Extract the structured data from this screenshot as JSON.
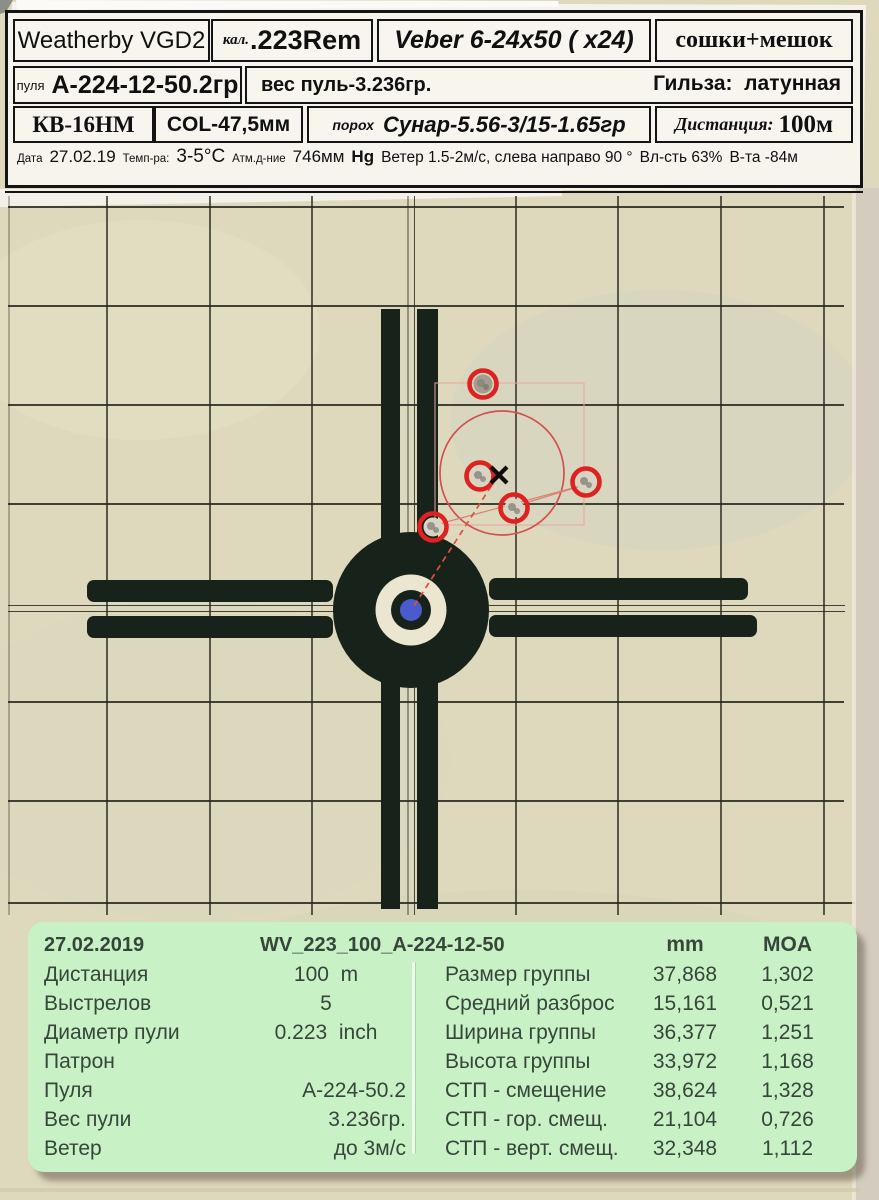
{
  "colors": {
    "paper": "#ded9bc",
    "cross_black": "#17221a",
    "grid_line": "#26261e",
    "bull_blue": "#4a5bcb",
    "annotation_red": "#d35050",
    "hole_ring_red": "#de2121",
    "panel_green": "#c9f1c6",
    "panel_text": "#36463a",
    "table_paper": "#f6f4ed"
  },
  "header_table": {
    "rifle": "Weatherby VGD2",
    "caliber_label": "кал.",
    "caliber": ".223Rem",
    "scope": "Veber 6-24x50 ( x24)",
    "rest": "сошки+мешок",
    "bullet_label": "пуля",
    "bullet": "А-224-12-50.2гр",
    "bullet_weight": "вес пуль-3.236гр.",
    "case_info": "Гильза:  латунная",
    "primer": "КВ-16НМ",
    "col": "COL-47,5мм",
    "powder_label": "порох",
    "powder": "Сунар-5.56-3/15-1.65гр",
    "distance_label": "Дистанция:",
    "distance": "100м",
    "date_label": "Дата",
    "date": "27.02.19",
    "temp_label": "Темп-ра:",
    "temp": "3-5°С",
    "pressure_label": "Атм.д-ние",
    "pressure": "746мм",
    "pressure_unit": "Hg",
    "wind": "Ветер 1.5-2м/с, слева направо 90 °",
    "humidity": "Вл-сть 63%",
    "altitude": "В-та -84м"
  },
  "target": {
    "aim_point": {
      "x": 411,
      "y": 610
    },
    "poi_mark": {
      "x": 499,
      "y": 475
    },
    "group_circle": {
      "cx": 502,
      "cy": 473,
      "r": 62
    },
    "shots": [
      {
        "x": 483,
        "y": 384,
        "dark": true
      },
      {
        "x": 480,
        "y": 476
      },
      {
        "x": 586,
        "y": 482
      },
      {
        "x": 514,
        "y": 508
      },
      {
        "x": 433,
        "y": 527
      }
    ]
  },
  "stats_panel": {
    "date": "27.02.2019",
    "session": "WV_223_100_А-224-12-50",
    "col_mm": "mm",
    "col_moa": "MOA",
    "left_rows": [
      {
        "label": "Дистанция",
        "value": "100  m"
      },
      {
        "label": "Выстрелов",
        "value": "5"
      },
      {
        "label": "Диаметр пули",
        "value": "0.223  inch"
      },
      {
        "label": "Патрон",
        "value": ""
      },
      {
        "label": "Пуля",
        "value": "А-224-50.2"
      },
      {
        "label": "Вес пули",
        "value": "3.236гр."
      },
      {
        "label": "Ветер",
        "value": "до 3м/с"
      }
    ],
    "right_rows": [
      {
        "label": "Размер группы",
        "mm": "37,868",
        "moa": "1,302"
      },
      {
        "label": "Средний разброс",
        "mm": "15,161",
        "moa": "0,521"
      },
      {
        "label": "Ширина группы",
        "mm": "36,377",
        "moa": "1,251"
      },
      {
        "label": "Высота группы",
        "mm": "33,972",
        "moa": "1,168"
      },
      {
        "label": "СТП - смещение",
        "mm": "38,624",
        "moa": "1,328"
      },
      {
        "label": "СТП - гор. смещ.",
        "mm": "21,104",
        "moa": "0,726"
      },
      {
        "label": "СТП - верт. смещ.",
        "mm": "32,348",
        "moa": "1,112"
      }
    ]
  }
}
